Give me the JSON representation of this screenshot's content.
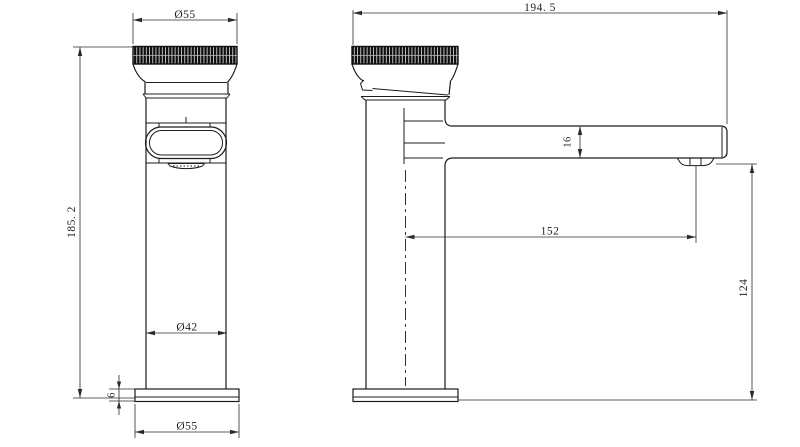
{
  "drawing": {
    "type": "technical-drawing",
    "subject": "basin faucet two-view dimensioned drawing",
    "units_implied": "mm",
    "colors": {
      "background": "#ffffff",
      "object_line": "#1c1c1c",
      "dimension_line": "#2b2b2b",
      "knurl_fill": "#0e0e0e"
    }
  },
  "labels": {
    "front_top_diameter": "Ø55",
    "front_height": "185. 2",
    "front_body_diameter": "Ø42",
    "front_base_height": "6",
    "front_base_diameter": "Ø55",
    "side_total_length": "194. 5",
    "side_spout_height": "16",
    "side_spout_reach": "152",
    "side_outlet_to_base": "124"
  }
}
